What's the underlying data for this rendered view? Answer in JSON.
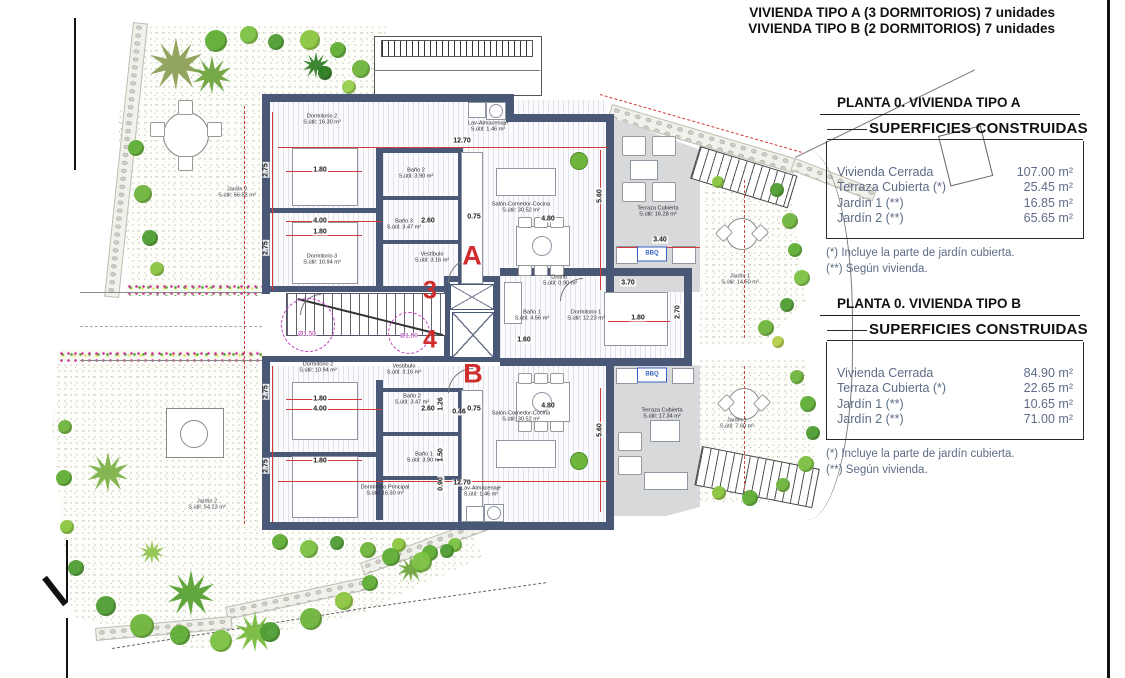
{
  "colors": {
    "wall": "#4a5878",
    "terrace": "#d8d9db",
    "annotation_red": "#d23a3a",
    "letter_red": "#d02c2c",
    "magenta": "#c23cc2",
    "bbq_blue": "#3a62c4",
    "panel_text": "#5d6c86",
    "garden_green": "#5fae35"
  },
  "header": {
    "line1": "VIVIENDA TIPO A (3 DORMITORIOS) 7 unidades",
    "line2": "VIVIENDA TIPO B (2 DORMITORIOS) 7 unidades"
  },
  "panels": [
    {
      "title": "PLANTA 0. VIVIENDA TIPO A",
      "box_title": "SUPERFICIES CONSTRUIDAS",
      "rows": [
        {
          "label": "Vivienda Cerrada",
          "value": "107.00 m²"
        },
        {
          "label": "Terraza Cubierta  (*)",
          "value": "25.45 m²"
        },
        {
          "label": "Jardín 1 (**)",
          "value": "16.85 m²"
        },
        {
          "label": "Jardín 2 (**)",
          "value": "65.65 m²"
        }
      ],
      "notes": [
        "(*)  Incluye la parte de jardín cubierta.",
        "(**) Según vivienda."
      ]
    },
    {
      "title": "PLANTA 0. VIVIENDA TIPO B",
      "box_title": "SUPERFICIES CONSTRUIDAS",
      "rows": [
        {
          "label": "Vivienda Cerrada",
          "value": "84.90 m²"
        },
        {
          "label": "Terraza Cubierta (*)",
          "value": "22.65 m²"
        },
        {
          "label": "Jardín 1 (**)",
          "value": "10.65 m²"
        },
        {
          "label": "Jardín 2 (**)",
          "value": "71.00 m²"
        }
      ],
      "notes": [
        "(*) Incluye la parte de jardín cubierta.",
        "(**) Según vivienda."
      ]
    }
  ],
  "plan": {
    "letters": [
      {
        "text": "A",
        "x": 472,
        "y": 256,
        "size": 27
      },
      {
        "text": "B",
        "x": 473,
        "y": 374,
        "size": 27
      },
      {
        "text": "3",
        "x": 430,
        "y": 291,
        "size": 25
      },
      {
        "text": "4",
        "x": 430,
        "y": 340,
        "size": 25
      }
    ],
    "rooms": [
      {
        "name": "Dormitorio 2",
        "area": "S.útil: 16.30 m²",
        "x": 322,
        "y": 120
      },
      {
        "name": "Dormitorio 3",
        "area": "S.útil: 10.94 m²",
        "x": 322,
        "y": 260
      },
      {
        "name": "Baño 2",
        "area": "S.útil: 3.90 m²",
        "x": 416,
        "y": 174
      },
      {
        "name": "Baño 3",
        "area": "S.útil: 3.47 m²",
        "x": 404,
        "y": 225
      },
      {
        "name": "Vestíbulo",
        "area": "S.útil: 3.16 m²",
        "x": 432,
        "y": 258
      },
      {
        "name": "Lav-Almacenaje",
        "area": "S.útil: 1.46 m²",
        "x": 488,
        "y": 127
      },
      {
        "name": "Salón-Comedor-Cocina",
        "area": "S.útil: 30.52 m²",
        "x": 521,
        "y": 208
      },
      {
        "name": "Terraza Cubierta",
        "area": "S.útil: 16.28 m²",
        "x": 658,
        "y": 212
      },
      {
        "name": "Distrib.",
        "area": "S.útil: 0.90 m²",
        "x": 560,
        "y": 281
      },
      {
        "name": "Baño 1",
        "area": "S.útil: 4.56 m²",
        "x": 532,
        "y": 316
      },
      {
        "name": "Dormitorio 1",
        "area": "S.útil: 12.23 m²",
        "x": 586,
        "y": 316
      },
      {
        "name": "Vestíbulo",
        "area": "S.útil: 3.16 m²",
        "x": 404,
        "y": 370
      },
      {
        "name": "Dormitorio 2",
        "area": "S.útil: 10.94 m²",
        "x": 318,
        "y": 368
      },
      {
        "name": "Baño 2",
        "area": "S.útil: 3.47 m²",
        "x": 412,
        "y": 400
      },
      {
        "name": "Baño 1",
        "area": "S.útil: 3.90 m²",
        "x": 424,
        "y": 458
      },
      {
        "name": "Dormitorio Principal",
        "area": "S.útil: 16.30 m²",
        "x": 385,
        "y": 491
      },
      {
        "name": "Lav-Almacenaje",
        "area": "S.útil: 1.46 m²",
        "x": 481,
        "y": 492
      },
      {
        "name": "Salón-Comedor-Cocina",
        "area": "S.útil: 30.52 m²",
        "x": 521,
        "y": 417
      },
      {
        "name": "Terraza Cubierta",
        "area": "S.útil: 17.34 m²",
        "x": 662,
        "y": 414
      }
    ],
    "gardens": [
      {
        "name": "Jardín 2",
        "area": "S.útil: 56.52 m²",
        "x": 237,
        "y": 193
      },
      {
        "name": "Jardín 2",
        "area": "S.útil: 54.23 m²",
        "x": 207,
        "y": 505
      },
      {
        "name": "Jardín 1",
        "area": "S.útil: 14.50 m²",
        "x": 740,
        "y": 280
      },
      {
        "name": "Jardín 1",
        "area": "S.útil: 7.60 m²",
        "x": 737,
        "y": 424
      }
    ],
    "dimensions": [
      {
        "t": "2.75",
        "x": 266,
        "y": 170,
        "rot": -90
      },
      {
        "t": "1.80",
        "x": 320,
        "y": 170
      },
      {
        "t": "4.00",
        "x": 320,
        "y": 221
      },
      {
        "t": "1.80",
        "x": 320,
        "y": 232
      },
      {
        "t": "2.60",
        "x": 428,
        "y": 221
      },
      {
        "t": "2.75",
        "x": 266,
        "y": 248,
        "rot": -90
      },
      {
        "t": "12.70",
        "x": 462,
        "y": 141
      },
      {
        "t": "0.75",
        "x": 474,
        "y": 217
      },
      {
        "t": "4.80",
        "x": 548,
        "y": 219
      },
      {
        "t": "5.60",
        "x": 600,
        "y": 196,
        "rot": -90
      },
      {
        "t": "3.40",
        "x": 660,
        "y": 240
      },
      {
        "t": "3.70",
        "x": 628,
        "y": 283
      },
      {
        "t": "1.80",
        "x": 638,
        "y": 318
      },
      {
        "t": "2.70",
        "x": 678,
        "y": 312,
        "rot": -90
      },
      {
        "t": "1.60",
        "x": 524,
        "y": 340
      },
      {
        "t": "2.75",
        "x": 266,
        "y": 392,
        "rot": -90
      },
      {
        "t": "1.80",
        "x": 320,
        "y": 399
      },
      {
        "t": "4.00",
        "x": 320,
        "y": 409
      },
      {
        "t": "2.60",
        "x": 428,
        "y": 409
      },
      {
        "t": "1.26",
        "x": 441,
        "y": 404,
        "rot": -90
      },
      {
        "t": "0.46",
        "x": 459,
        "y": 412
      },
      {
        "t": "0.75",
        "x": 474,
        "y": 409
      },
      {
        "t": "4.80",
        "x": 548,
        "y": 406
      },
      {
        "t": "5.60",
        "x": 600,
        "y": 430,
        "rot": -90
      },
      {
        "t": "1.80",
        "x": 320,
        "y": 461
      },
      {
        "t": "2.75",
        "x": 266,
        "y": 466,
        "rot": -90
      },
      {
        "t": "1.50",
        "x": 441,
        "y": 455,
        "rot": -90
      },
      {
        "t": "0.90",
        "x": 441,
        "y": 484,
        "rot": -90
      },
      {
        "t": "12.70",
        "x": 462,
        "y": 483
      }
    ],
    "diameter_labels": [
      {
        "t": "Ø1,50",
        "x": 307,
        "y": 334
      },
      {
        "t": "Ø1,50",
        "x": 409,
        "y": 336
      }
    ],
    "bbq_labels": [
      {
        "label": "BBQ",
        "x": 652,
        "y": 254
      },
      {
        "label": "BBQ",
        "x": 652,
        "y": 375
      }
    ]
  }
}
